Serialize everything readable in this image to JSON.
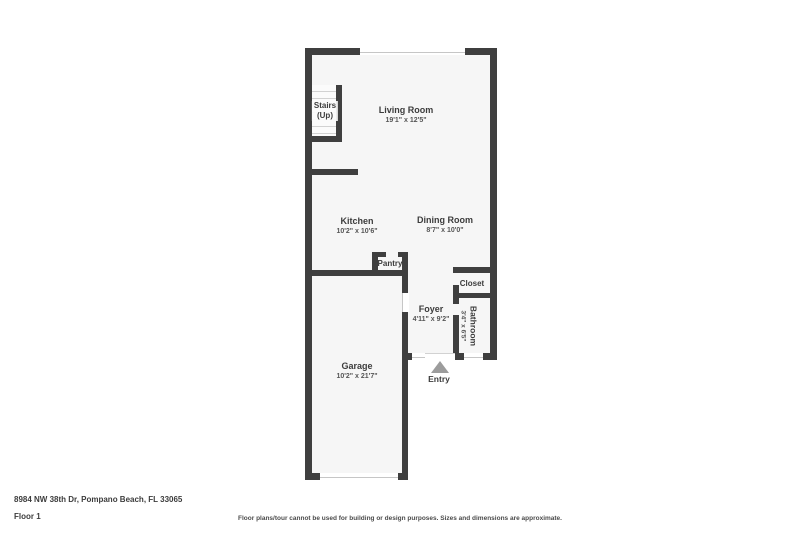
{
  "theme": {
    "wall_color": "#3f3f3f",
    "floor_color": "#f6f6f6",
    "text_color": "#3c3c3c",
    "arrow_color": "#9c9c9c",
    "background": "#ffffff"
  },
  "floorplan": {
    "rooms": [
      {
        "name": "Living Room",
        "dims": "19'1\" x 12'5\""
      },
      {
        "name": "Kitchen",
        "dims": "10'2\" x 10'6\""
      },
      {
        "name": "Dining Room",
        "dims": "8'7\" x 10'0\""
      },
      {
        "name": "Foyer",
        "dims": "4'11\" x 9'2\""
      },
      {
        "name": "Garage",
        "dims": "10'2\" x 21'7\""
      },
      {
        "name": "Bathroom",
        "dims": "3'4\" x 6'5\""
      }
    ],
    "labels": {
      "stairs_line1": "Stairs",
      "stairs_line2": "(Up)",
      "pantry": "Pantry",
      "closet": "Closet",
      "entry": "Entry"
    }
  },
  "footer": {
    "address": "8984 NW 38th Dr, Pompano Beach, FL 33065",
    "floor_label": "Floor 1",
    "disclaimer": "Floor plans/tour cannot be used for building or design purposes. Sizes and dimensions are approximate."
  }
}
